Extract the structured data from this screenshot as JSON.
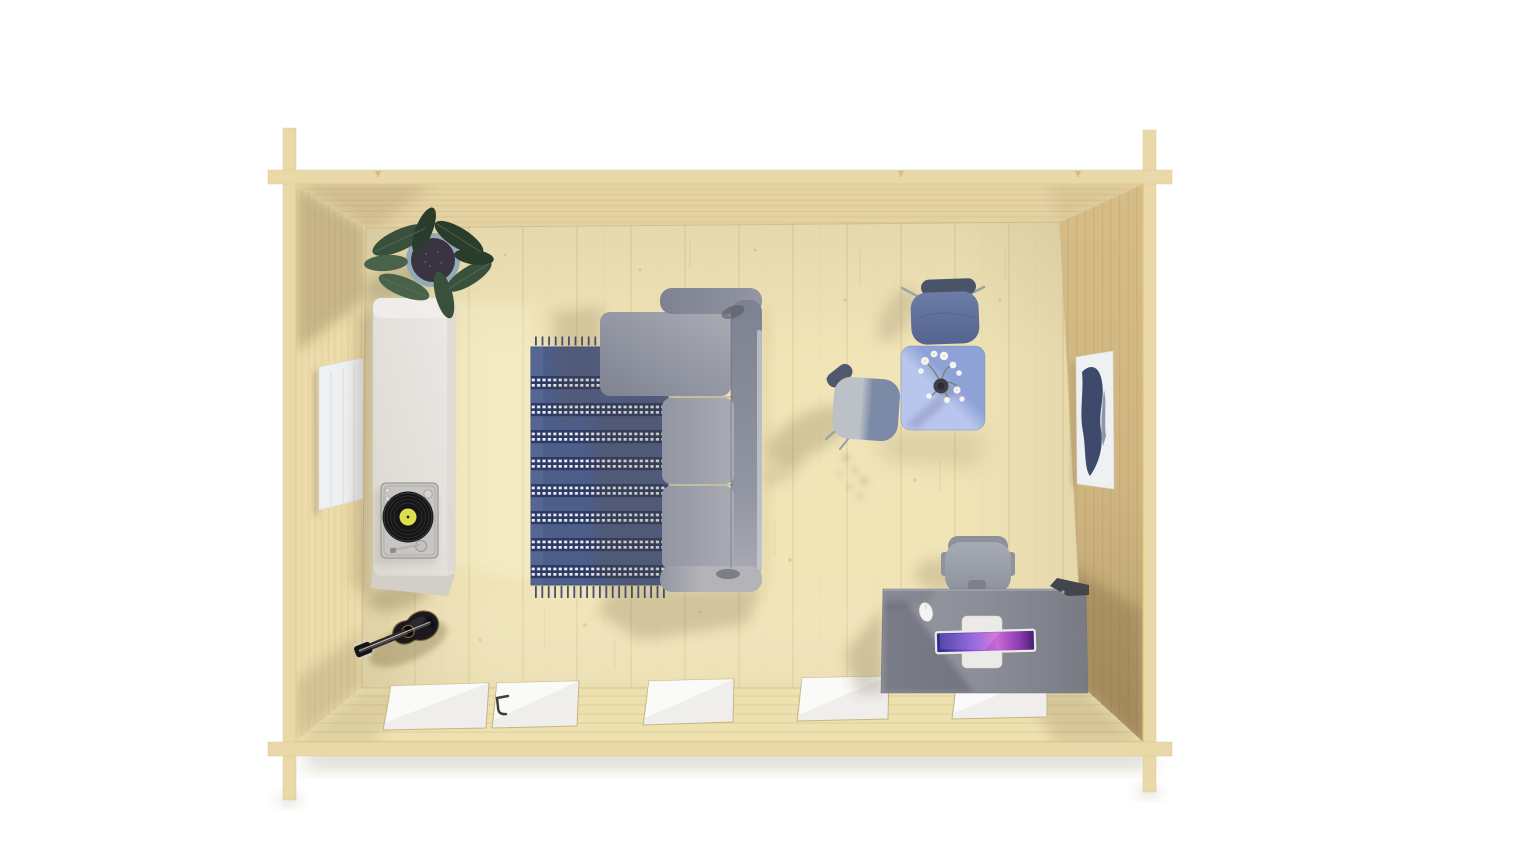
{
  "meta": {
    "canvas_width": 1536,
    "canvas_height": 864,
    "subject": "top-down 3D render of a wooden log cabin interior on a white background"
  },
  "palette": {
    "bg": "#ffffff",
    "band": "#ead9a8",
    "bandEdge": "#d3bd85",
    "bandHighlight": "#e8c469",
    "topWallFace": "#e4d2a3",
    "leftWallFace": "#ecdcab",
    "rightWallFace": "#d6bc86",
    "bottomWallFace": "#eee1b0",
    "wallLine": "#c9b27c",
    "rightWallLine": "#bfa269",
    "floor": "#f1e5b8",
    "floorLine": "#dccb96",
    "floorJunction": "#c7b57f",
    "shadow": "#5a4726",
    "glass": "#efeeec",
    "glassLight": "#fbfbf9",
    "handle": "#453e32",
    "canvasWhite": "#eef0f2",
    "artNavy": "#2e3c5f",
    "cabinet": "#eceae6",
    "cabinetShade": "#dbd7d2",
    "cabinetSide": "#d2cec8",
    "player": "#c7c6c3",
    "playerEdge": "#8f8d88",
    "vinyl": "#161618",
    "vinylRing": "#38383c",
    "label": "#dde04e",
    "rugBase": "#4e5e8b",
    "rugStripe": "#2c3b63",
    "rugDot": "#e9edf5",
    "rugFringe": "#434f78",
    "sofa": "#9296a2",
    "sofaLight": "#a9abb4",
    "sofaDark": "#7f838f",
    "sofaBar": "#7d8191",
    "sofaBarLight": "#b4b3b8",
    "table": "#8fa2d6",
    "tableLight": "#b8c5ec",
    "vase": "#403f49",
    "stem": "#6f7d55",
    "flower": "#f5f4f2",
    "chairBlue": "#55648e",
    "chairBlueLight": "#6b7ca7",
    "chairBlueBack": "#4a5469",
    "chairGrayLight": "#bcc1c8",
    "chairGrayDark": "#7b8aa7",
    "chairLeg": "#99a0a8",
    "deskLight": "#979aa3",
    "deskTop": "#8b8d97",
    "deskDark": "#787a84",
    "officeChair": "#a6aab3",
    "officeChairDark": "#8d919b",
    "laptopBody": "#ebeae6",
    "screen1": "#2f2590",
    "screen2": "#7e4fd8",
    "screen3": "#c968d6",
    "screen4": "#3f1f6e",
    "mouse": "#f4f3f1",
    "lamp": "#43464c",
    "guitarBody": "#1a191d",
    "guitarRim": "#6e5130",
    "guitarNeck": "#2a2328",
    "pot": "#93abb8",
    "soil": "#3a3340",
    "leaf": "#38503c",
    "leafDark": "#2a3d2d",
    "leafLight": "#49624a"
  },
  "scene": {
    "type": "architectural render, bird's-eye view",
    "structure": {
      "walls": [
        "top",
        "left",
        "right",
        "bottom"
      ],
      "corner_joints": "crossed log beam ends at all four corners",
      "floor": "pale wood planks running vertically"
    },
    "furniture": [
      {
        "name": "potted-plant",
        "position": "top-left corner",
        "detail": "dark green leaves in a blue-gray pot"
      },
      {
        "name": "sideboard",
        "position": "along left wall",
        "detail": "white, long"
      },
      {
        "name": "turntable",
        "position": "on sideboard",
        "detail": "silver deck, black vinyl record, yellow label"
      },
      {
        "name": "acoustic-guitar",
        "position": "bottom-left, leaning on left wall",
        "detail": "black body"
      },
      {
        "name": "striped-rug",
        "position": "center-left",
        "detail": "blue with white dotted stripes and fringe"
      },
      {
        "name": "sectional-sofa",
        "position": "center",
        "detail": "gray L-shaped, chaise to the left"
      },
      {
        "name": "bistro-table",
        "position": "top-right",
        "detail": "square blue top with flower vase"
      },
      {
        "name": "side-chair-blue",
        "position": "above bistro table"
      },
      {
        "name": "side-chair-gray",
        "position": "left of bistro table"
      },
      {
        "name": "office-desk",
        "position": "bottom-right",
        "detail": "gray top with open laptop, mouse and black desk lamp"
      },
      {
        "name": "office-chair",
        "position": "tucked into desk"
      }
    ],
    "wall_decor": [
      {
        "name": "blank-canvas",
        "position": "left wall",
        "detail": "white"
      },
      {
        "name": "mountain-artwork",
        "position": "right wall",
        "detail": "navy abstract on white canvas"
      }
    ],
    "openings": [
      {
        "name": "glazed-double-door",
        "position": "bottom wall left of center",
        "detail": "white glass panes, dark handle"
      },
      {
        "name": "window",
        "count": 3,
        "position": "bottom wall"
      }
    ],
    "lighting": "sun from upper right, soft shadows falling to lower left"
  }
}
